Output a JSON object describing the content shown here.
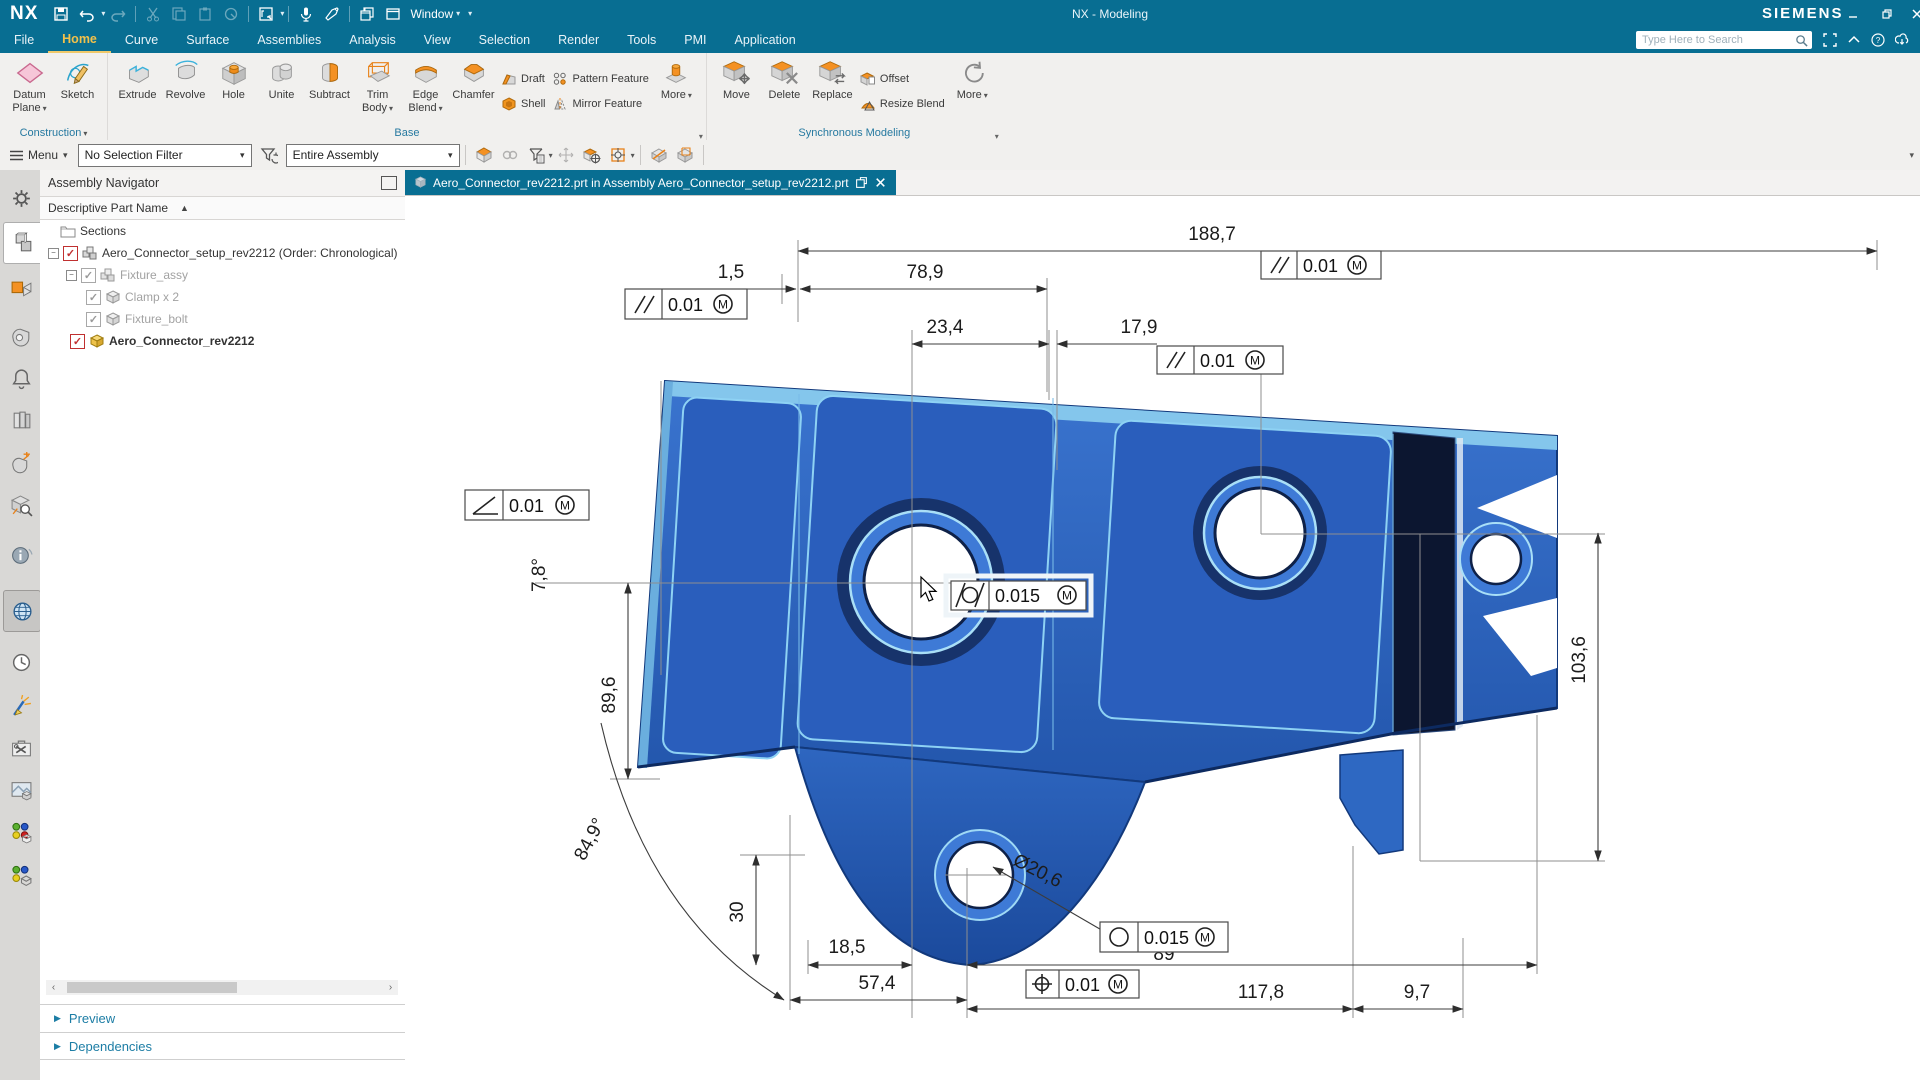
{
  "titlebar": {
    "logo": "NX",
    "title": "NX - Modeling",
    "brand": "SIEMENS",
    "window_menu": "Window"
  },
  "menubar": {
    "tabs": [
      "File",
      "Home",
      "Curve",
      "Surface",
      "Assemblies",
      "Analysis",
      "View",
      "Selection",
      "Render",
      "Tools",
      "PMI",
      "Application"
    ],
    "active_tab": "Home",
    "search_placeholder": "Type Here to Search"
  },
  "ribbon": {
    "construction": {
      "label": "Construction",
      "datum_plane": "Datum Plane",
      "sketch": "Sketch"
    },
    "base": {
      "label": "Base",
      "extrude": "Extrude",
      "revolve": "Revolve",
      "hole": "Hole",
      "unite": "Unite",
      "subtract": "Subtract",
      "trim_body": "Trim Body",
      "edge_blend": "Edge Blend",
      "chamfer": "Chamfer",
      "draft": "Draft",
      "shell": "Shell",
      "pattern_feature": "Pattern Feature",
      "mirror_feature": "Mirror Feature",
      "more": "More"
    },
    "sync": {
      "label": "Synchronous Modeling",
      "move": "Move",
      "delete": "Delete",
      "replace": "Replace",
      "offset": "Offset",
      "resize_blend": "Resize Blend",
      "more": "More"
    }
  },
  "toolbar": {
    "menu": "Menu",
    "selection_filter": "No Selection Filter",
    "scope": "Entire Assembly"
  },
  "dock": {
    "icons": [
      "settings-gear",
      "assembly-navigator",
      "constraint-navigator",
      "part-navigator",
      "alerts-bell",
      "history-stack",
      "datum-measure",
      "part-search",
      "information",
      "internet-globe",
      "history-clock",
      "feature-wand",
      "toolbox",
      "render-materials",
      "reuse-library",
      "color-palette"
    ]
  },
  "navigator": {
    "title": "Assembly Navigator",
    "column": "Descriptive Part Name",
    "rows": [
      {
        "label": "Sections"
      },
      {
        "label": "Aero_Connector_setup_rev2212 (Order: Chronological)"
      },
      {
        "label": "Fixture_assy"
      },
      {
        "label": "Clamp x 2"
      },
      {
        "label": "Fixture_bolt"
      },
      {
        "label": "Aero_Connector_rev2212"
      }
    ],
    "preview": "Preview",
    "dependencies": "Dependencies"
  },
  "tabbar": {
    "active_tab": "Aero_Connector_rev2212.prt in Assembly Aero_Connector_setup_rev2212.prt"
  },
  "pmi": {
    "dims": {
      "overall": "188,7",
      "gap": "1,5",
      "w1": "78,9",
      "w2": "23,4",
      "w3": "17,9",
      "a1": "7,8°",
      "h1": "89,6",
      "a2": "84,9°",
      "h2": "30",
      "o1": "18,5",
      "o2": "57,4",
      "dia": "Ø20,6",
      "s89": "89",
      "s117": "117,8",
      "s97": "9,7",
      "h3": "103,6"
    },
    "fcf": {
      "top": {
        "symbol": "parallelism",
        "value": "0.01",
        "mod": "M"
      },
      "left": {
        "symbol": "parallelism",
        "value": "0.01",
        "mod": "M"
      },
      "mid": {
        "symbol": "parallelism",
        "value": "0.01",
        "mod": "M"
      },
      "ang": {
        "symbol": "angularity",
        "value": "0.01",
        "mod": "M"
      },
      "cyl": {
        "symbol": "cylindricity",
        "value": "0.015",
        "mod": "M"
      },
      "circ": {
        "symbol": "circularity",
        "value": "0.015",
        "mod": "M"
      },
      "pos": {
        "symbol": "position",
        "value": "0.01",
        "mod": "M"
      }
    }
  },
  "colors": {
    "titlebar": "#086e92",
    "active_tab_text": "#f2c14b",
    "part_blue": "#2e68c2",
    "part_dark": "#0c1630",
    "group_label": "#2679a0",
    "accent_orange": "#f49123"
  }
}
